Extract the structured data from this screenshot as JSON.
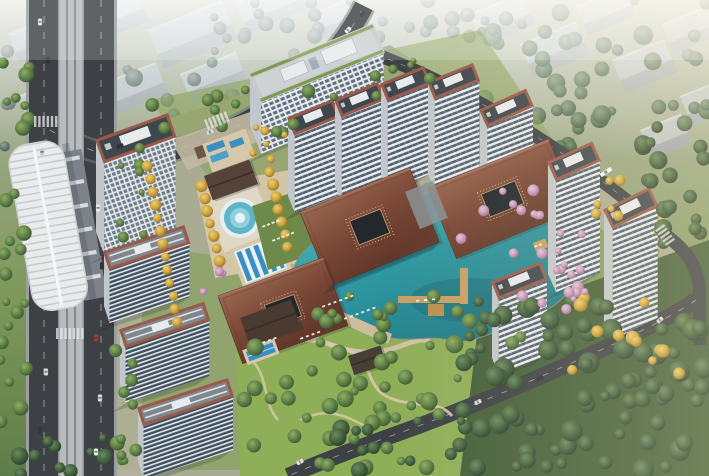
{
  "scene": {
    "label": "aerial-rendering-residential-complex",
    "description": "Bird's-eye architectural rendering: residential towers around a central turquoise lake with terracotta pavilions, pools, autumn trees, elevated rail line on the left and forest at bottom right"
  },
  "palette": {
    "haze": "#e3e9e8",
    "road": "#3d4145",
    "roadEdge": "#9aa0a0",
    "viaduct": "#b7bbbe",
    "rail": "#787e82",
    "stationRoof": "#e9ebec",
    "platform": "#7c8287",
    "facadeWhite": "#eceded",
    "facadeGlass": "#4e6070",
    "slabGlass": "#3d4e5c",
    "facadeSide": "#c2c7cb",
    "crown": "#9a5a49",
    "roofDark": "#3f474e",
    "roofSlab": "#80878c",
    "penthouse": "#e8eaec",
    "greenRoof": "#7f9b4f",
    "pavA": "#9a6750",
    "pavB": "#7a4736",
    "pavC": "#63382b",
    "waterA": "#56c3c2",
    "waterB": "#2f97a0",
    "waterC": "#1f7784",
    "poolBlue": "#3b8fc0",
    "deck": "#d6c9ab",
    "paving": "#c3b9a2",
    "lawn": "#7f9b52",
    "parkLawn": "#8fae58",
    "forestBase": "#445f3a",
    "pathCol": "#d8cdab",
    "pier": "#c79f63",
    "shadow": "#1e2a2e"
  },
  "city_blocks": [
    [
      8,
      34,
      54,
      20,
      12
    ],
    [
      70,
      12,
      70,
      24,
      14
    ],
    [
      148,
      30,
      80,
      26,
      16
    ],
    [
      235,
      2,
      64,
      22,
      12
    ],
    [
      180,
      74,
      60,
      20,
      12
    ],
    [
      96,
      86,
      64,
      22,
      12
    ],
    [
      18,
      96,
      40,
      18,
      10
    ],
    [
      310,
      14,
      50,
      18,
      10
    ],
    [
      470,
      14,
      56,
      22,
      12
    ],
    [
      520,
      44,
      60,
      22,
      14
    ],
    [
      576,
      6,
      52,
      20,
      12
    ],
    [
      612,
      60,
      56,
      22,
      14
    ],
    [
      662,
      24,
      48,
      20,
      12
    ],
    [
      680,
      96,
      40,
      20,
      12
    ],
    [
      640,
      130,
      44,
      20,
      12
    ]
  ],
  "buildings": [
    {
      "type": "office",
      "x": 250,
      "y": 74,
      "ang": 22,
      "w": 132,
      "rd": 30,
      "fh": 52,
      "late": false
    },
    {
      "type": "tower",
      "x": 288,
      "y": 118,
      "ang": 22,
      "w": 48,
      "rd": 18,
      "fh": 78,
      "late": false
    },
    {
      "type": "tower",
      "x": 335,
      "y": 100,
      "ang": 22,
      "w": 46,
      "rd": 18,
      "fh": 86,
      "late": false
    },
    {
      "type": "tower",
      "x": 381,
      "y": 84,
      "ang": 22,
      "w": 46,
      "rd": 18,
      "fh": 90,
      "late": false
    },
    {
      "type": "tower",
      "x": 428,
      "y": 82,
      "ang": 22,
      "w": 48,
      "rd": 18,
      "fh": 92,
      "late": false
    },
    {
      "type": "tower",
      "x": 480,
      "y": 110,
      "ang": 24,
      "w": 50,
      "rd": 18,
      "fh": 88,
      "late": false
    },
    {
      "type": "tower",
      "x": 548,
      "y": 162,
      "ang": 24,
      "w": 48,
      "rd": 20,
      "fh": 112,
      "late": true
    },
    {
      "type": "tower",
      "x": 604,
      "y": 210,
      "ang": 26,
      "w": 50,
      "rd": 20,
      "fh": 112,
      "late": true
    },
    {
      "type": "tower-grid",
      "x": 96,
      "y": 140,
      "ang": 20,
      "w": 76,
      "rd": 24,
      "fh": 92,
      "late": true
    },
    {
      "type": "slab",
      "x": 104,
      "y": 252,
      "ang": 18,
      "w": 84,
      "rd": 18,
      "fh": 54,
      "late": true
    },
    {
      "type": "tower",
      "x": 492,
      "y": 282,
      "ang": 22,
      "w": 52,
      "rd": 18,
      "fh": 76,
      "late": true
    },
    {
      "type": "slab",
      "x": 120,
      "y": 330,
      "ang": 18,
      "w": 88,
      "rd": 18,
      "fh": 56,
      "late": true
    },
    {
      "type": "slab",
      "x": 138,
      "y": 408,
      "ang": 18,
      "w": 94,
      "rd": 18,
      "fh": 54,
      "late": true
    }
  ],
  "pavilions": [
    {
      "x": 300,
      "y": 212,
      "ang": 22,
      "w": 118,
      "h": 80
    },
    {
      "x": 428,
      "y": 188,
      "ang": 22,
      "w": 130,
      "h": 76
    },
    {
      "x": 218,
      "y": 296,
      "ang": 20,
      "w": 112,
      "h": 72
    }
  ],
  "minor_roofs": [
    {
      "x": 204,
      "y": 176,
      "ang": 20,
      "w": 48,
      "h": 26,
      "color": "#55433a"
    },
    {
      "x": 240,
      "y": 318,
      "ang": 20,
      "w": 54,
      "h": 30,
      "color": "#4a3a31"
    },
    {
      "x": 348,
      "y": 356,
      "ang": 18,
      "w": 34,
      "h": 20,
      "color": "#463f36"
    }
  ],
  "tree_regions": [
    [
      0,
      0,
      709,
      56,
      26,
      "city",
      4,
      8,
      "back"
    ],
    [
      0,
      56,
      250,
      100,
      22,
      "city",
      4,
      9,
      "back"
    ],
    [
      430,
      0,
      279,
      148,
      44,
      "dark",
      4,
      10,
      "back"
    ],
    [
      250,
      0,
      180,
      38,
      10,
      "city",
      5,
      8,
      "back"
    ],
    [
      0,
      60,
      30,
      400,
      26,
      "mid",
      4,
      8,
      "front"
    ],
    [
      112,
      330,
      26,
      146,
      12,
      "mid",
      4,
      8,
      "front"
    ],
    [
      462,
      296,
      247,
      180,
      88,
      "dark",
      5,
      11,
      "front"
    ],
    [
      244,
      336,
      215,
      132,
      40,
      "mid",
      4,
      9,
      "front"
    ],
    [
      150,
      88,
      240,
      46,
      14,
      "mid",
      4,
      7,
      "front"
    ],
    [
      560,
      296,
      120,
      80,
      12,
      "gold",
      4,
      7,
      "front"
    ],
    [
      588,
      176,
      80,
      60,
      9,
      "gold",
      3,
      6,
      "front"
    ],
    [
      452,
      188,
      96,
      52,
      9,
      "pink",
      3,
      6,
      "front"
    ],
    [
      492,
      248,
      90,
      68,
      10,
      "pink",
      3,
      6,
      "front"
    ],
    [
      552,
      232,
      52,
      80,
      8,
      "pink",
      3,
      6,
      "front"
    ],
    [
      286,
      296,
      260,
      52,
      16,
      "mid",
      4,
      8,
      "front"
    ],
    [
      196,
      262,
      44,
      46,
      4,
      "pink",
      3,
      5,
      "front"
    ],
    [
      118,
      140,
      30,
      110,
      8,
      "mid",
      3,
      6,
      "front"
    ],
    [
      240,
      120,
      60,
      40,
      6,
      "gold",
      3,
      6,
      "front"
    ],
    [
      330,
      420,
      150,
      56,
      14,
      "dark",
      4,
      9,
      "front"
    ],
    [
      640,
      120,
      69,
      130,
      18,
      "dark",
      5,
      10,
      "front"
    ],
    [
      0,
      430,
      120,
      46,
      10,
      "dark",
      4,
      9,
      "front"
    ],
    [
      360,
      60,
      70,
      30,
      5,
      "mid",
      3,
      6,
      "front"
    ]
  ],
  "gold_rows": [
    [
      202,
      186,
      3,
      12.5,
      7,
      5.5
    ],
    [
      270,
      172,
      3,
      12.5,
      7,
      5.5
    ],
    [
      148,
      166,
      2.5,
      13,
      13,
      5
    ]
  ],
  "cars": [
    [
      40,
      22,
      90,
      "#d9dbdd",
      7
    ],
    [
      48,
      60,
      90,
      "#2e3338",
      7
    ],
    [
      42,
      152,
      90,
      "#c8cacc",
      7
    ],
    [
      46,
      372,
      90,
      "#d9dadb",
      7
    ],
    [
      40,
      430,
      90,
      "#33383d",
      7
    ],
    [
      98,
      208,
      90,
      "#e8e9ea",
      7
    ],
    [
      102,
      266,
      90,
      "#2f343a",
      7
    ],
    [
      96,
      338,
      90,
      "#b23434",
      7
    ],
    [
      100,
      398,
      90,
      "#dadcdd",
      7
    ],
    [
      96,
      452,
      90,
      "#e9eaeb",
      7
    ],
    [
      348,
      30,
      -45,
      "#e8e9ea",
      7
    ],
    [
      362,
      14,
      -45,
      "#2f353b",
      7
    ],
    [
      210,
      132,
      -20,
      "#d8dadc",
      7
    ],
    [
      120,
      146,
      -15,
      "#2e3338",
      7
    ],
    [
      606,
      172,
      -33,
      "#f2f3f4",
      13
    ],
    [
      300,
      462,
      -28,
      "#e8e9ea",
      7
    ],
    [
      478,
      402,
      -27,
      "#dcdee0",
      7
    ],
    [
      540,
      378,
      -27,
      "#2e3338",
      7
    ],
    [
      660,
      320,
      -40,
      "#d9dbdc",
      7
    ]
  ],
  "crosswalks": [
    [
      204,
      120,
      -22,
      6
    ],
    [
      56,
      328,
      0,
      7
    ],
    [
      664,
      224,
      55,
      5
    ],
    [
      34,
      116,
      0,
      6
    ]
  ],
  "loungers": [
    [
      262,
      226,
      -21,
      4,
      5
    ],
    [
      272,
      240,
      -21,
      5,
      5
    ],
    [
      322,
      306,
      -20,
      6,
      6
    ],
    [
      344,
      318,
      -20,
      6,
      6
    ],
    [
      300,
      338,
      -20,
      4,
      6
    ],
    [
      262,
      342,
      -20,
      3,
      6
    ],
    [
      534,
      246,
      -20,
      2,
      5
    ],
    [
      416,
      300,
      -5,
      3,
      8
    ]
  ]
}
